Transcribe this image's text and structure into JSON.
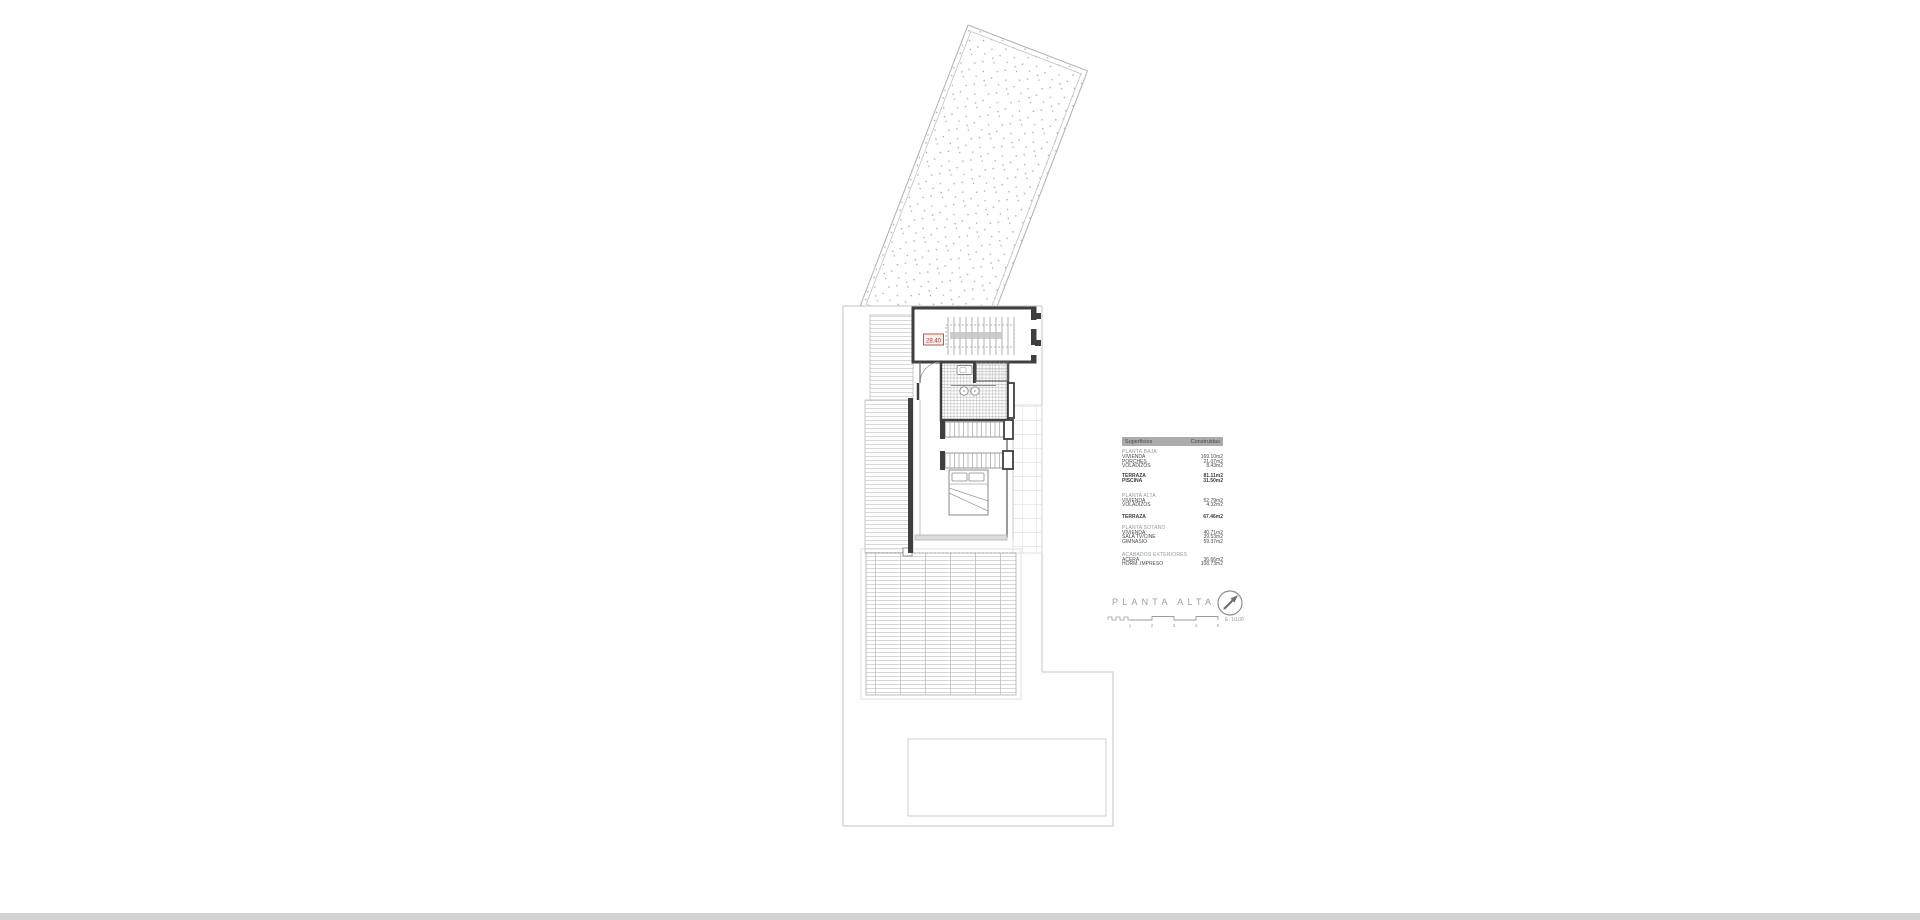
{
  "plan": {
    "dimension_label": "28.40"
  },
  "areas_table": {
    "header": {
      "col1": "Superficies",
      "col2": "Construidas"
    },
    "sections": [
      {
        "title": "PLANTA BAJA",
        "rows": [
          {
            "label": "VIVIENDA",
            "value": "169.10m2"
          },
          {
            "label": "PORCHES",
            "value": "21.07m2"
          },
          {
            "label": "VOLADIZOS",
            "value": "8.43m2"
          }
        ]
      },
      {
        "title": "",
        "rows": [
          {
            "label": "TERRAZA",
            "value": "81.11m2"
          },
          {
            "label": "PISCINA",
            "value": "31.50m2"
          }
        ]
      },
      {
        "title": "PLANTA ALTA",
        "rows": [
          {
            "label": "VIVIENDA",
            "value": "52.79m2"
          },
          {
            "label": "VOLADIZOS",
            "value": "4.32m2"
          }
        ]
      },
      {
        "title": "",
        "rows": [
          {
            "label": "TERRAZA",
            "value": "67.46m2"
          }
        ]
      },
      {
        "title": "PLANTA SOTANO",
        "rows": [
          {
            "label": "VIVIENDA",
            "value": "40.71m2"
          },
          {
            "label": "SALA TV/CINE",
            "value": "39.53m2"
          },
          {
            "label": "GIMNASIO",
            "value": "59.37m2"
          }
        ]
      },
      {
        "title": "ACABADOS EXTERIORES",
        "rows": [
          {
            "label": "ACERA",
            "value": "36.66m2"
          },
          {
            "label": "HORM. IMPRESO",
            "value": "108.73m2"
          }
        ]
      }
    ]
  },
  "title_block": {
    "title": "PLANTA ALTA",
    "scale_label": "E: 1/100",
    "scale_ticks": [
      "1",
      "2",
      "3",
      "4",
      "5"
    ]
  },
  "colors": {
    "dimension_red": "#a13c34",
    "wall_dark": "#3f3f3f",
    "table_header_grey": "#ababab",
    "section_label_grey_blue": "#8d9aa4",
    "title_grey": "#9aa0a3"
  }
}
